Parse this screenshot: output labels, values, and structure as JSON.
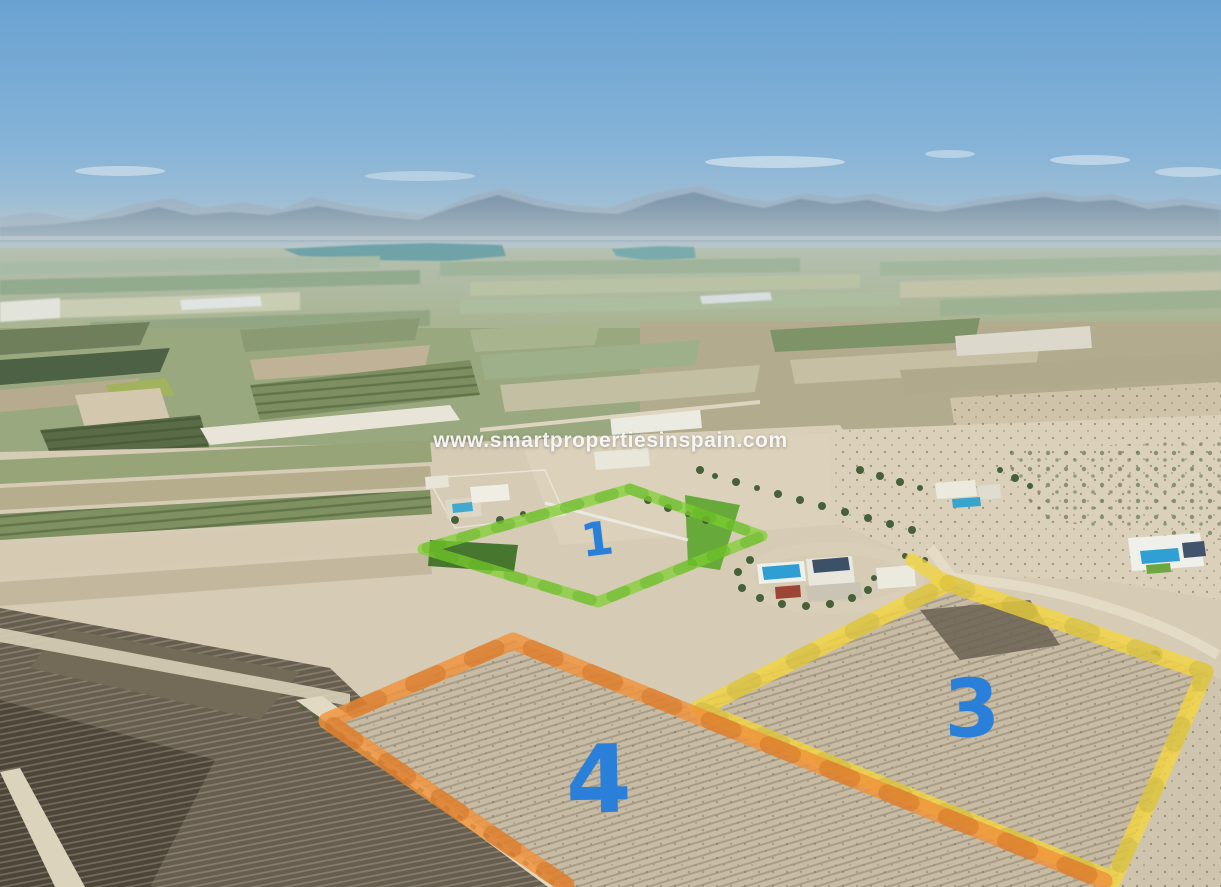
{
  "watermark": {
    "text": "www.smartpropertiesinspain.com"
  },
  "plots": [
    {
      "id": "plot-1",
      "label": "1",
      "outline": "green",
      "color": "#7dd02f"
    },
    {
      "id": "plot-3",
      "label": "3",
      "outline": "yellow",
      "color": "#f2d53e"
    },
    {
      "id": "plot-4",
      "label": "4",
      "outline": "orange",
      "color": "#f0923a"
    }
  ],
  "label_color": "#2a7fd8"
}
